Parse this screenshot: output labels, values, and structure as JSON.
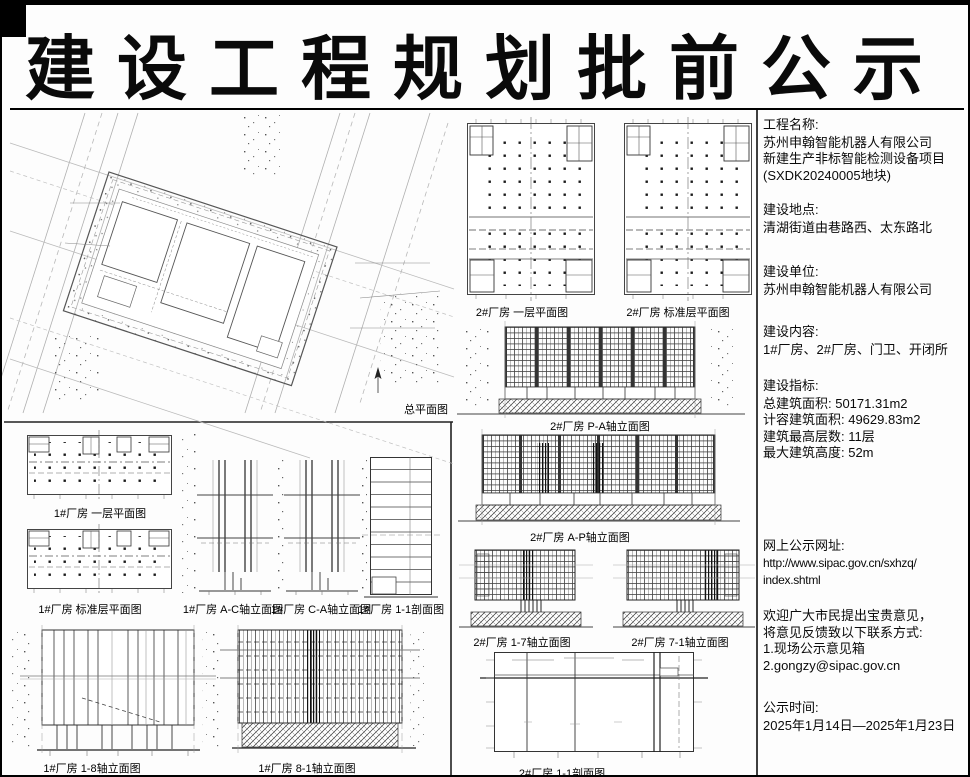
{
  "page": {
    "title": "建设工程规划批前公示"
  },
  "colors": {
    "paper": "#fdfdfd",
    "ink": "#0a0a0a",
    "line_gray": "#777777"
  },
  "icons": {
    "north_arrow": "▲"
  },
  "drawings": {
    "site_plan": {
      "label": "总平面图"
    },
    "plan1_f1": {
      "label": "1#厂房 一层平面图"
    },
    "plan1_std": {
      "label": "1#厂房 标准层平面图"
    },
    "elev1_ac": {
      "label": "1#厂房 A-C轴立面图"
    },
    "elev1_ca": {
      "label": "1#厂房 C-A轴立面图"
    },
    "sect1_11": {
      "label": "1#厂房 1-1剖面图"
    },
    "elev1_18": {
      "label": "1#厂房 1-8轴立面图"
    },
    "elev1_81": {
      "label": "1#厂房 8-1轴立面图"
    },
    "plan2_f1": {
      "label": "2#厂房 一层平面图"
    },
    "plan2_std": {
      "label": "2#厂房 标准层平面图"
    },
    "elev2_pa": {
      "label": "2#厂房 P-A轴立面图"
    },
    "elev2_ap": {
      "label": "2#厂房 A-P轴立面图"
    },
    "elev2_17": {
      "label": "2#厂房 1-7轴立面图"
    },
    "elev2_71": {
      "label": "2#厂房 7-1轴立面图"
    },
    "sect2_11": {
      "label": "2#厂房 1-1剖面图"
    }
  },
  "info_panel": {
    "project": {
      "heading": "工程名称:",
      "lines": [
        "苏州申翰智能机器人有限公司",
        "新建生产非标智能检测设备项目",
        "(SXDK20240005地块)"
      ]
    },
    "location": {
      "heading": "建设地点:",
      "lines": [
        "清湖街道由巷路西、太东路北"
      ]
    },
    "builder": {
      "heading": "建设单位:",
      "lines": [
        "苏州申翰智能机器人有限公司"
      ]
    },
    "content": {
      "heading": "建设内容:",
      "lines": [
        "1#厂房、2#厂房、门卫、开闭所"
      ]
    },
    "indicators": {
      "heading": "建设指标:",
      "lines": [
        "总建筑面积: 50171.31m2",
        "计容建筑面积: 49629.83m2",
        "建筑最高层数: 11层",
        "最大建筑高度: 52m"
      ]
    },
    "website": {
      "heading": "网上公示网址:",
      "lines": [
        "http://www.sipac.gov.cn/sxhzq/",
        "index.shtml"
      ]
    },
    "feedback": {
      "lines": [
        "欢迎广大市民提出宝贵意见，",
        "将意见反馈致以下联系方式:",
        "1.现场公示意见箱",
        "2.gongzy@sipac.gov.cn"
      ]
    },
    "period": {
      "heading": "公示时间:",
      "lines": [
        "2025年1月14日—2025年1月23日"
      ]
    }
  }
}
